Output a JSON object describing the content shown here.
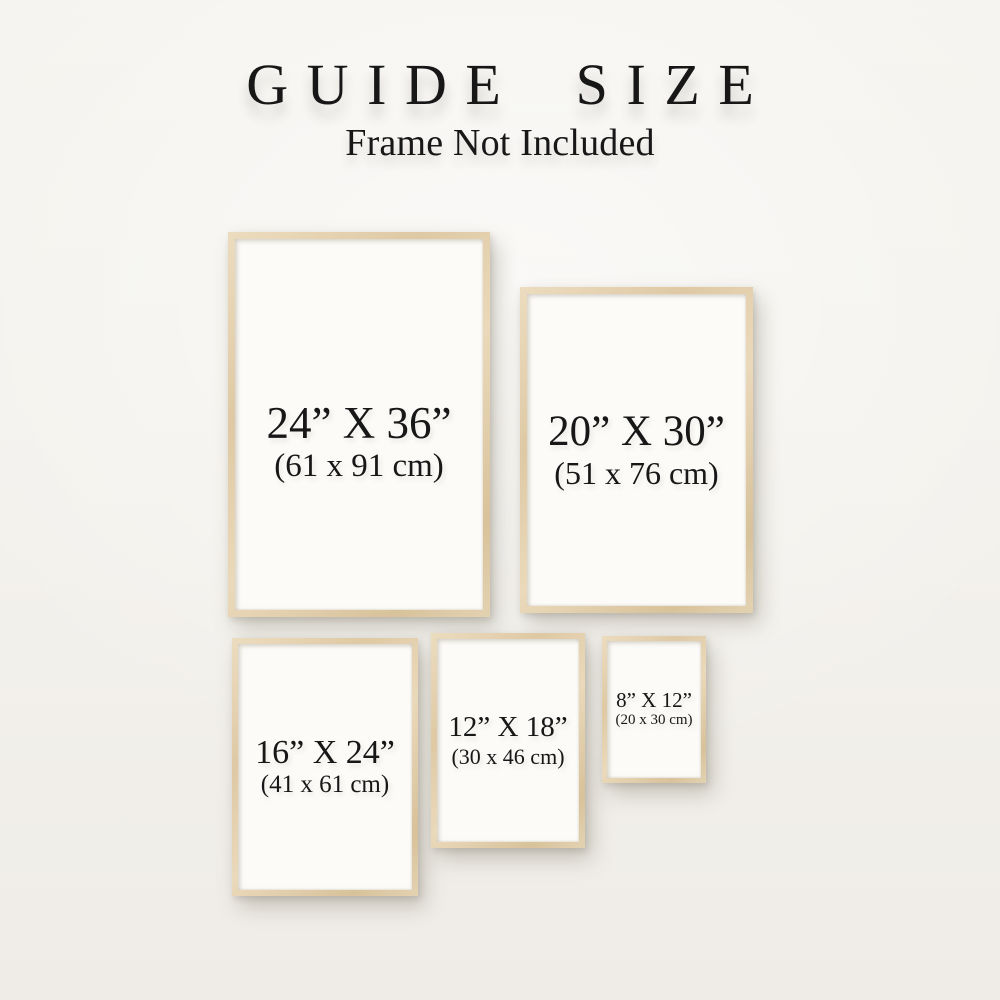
{
  "colors": {
    "background": "#f3f1ec",
    "frame_wood": "#dfc9a4",
    "paper": "#fcfbf8",
    "text": "#171717"
  },
  "header": {
    "title": "GUIDE SIZE",
    "subtitle": "Frame Not Included"
  },
  "frames": [
    {
      "name": "frame-24x36",
      "inches": "24” X 36”",
      "cm": "(61 x 91 cm)"
    },
    {
      "name": "frame-20x30",
      "inches": "20” X 30”",
      "cm": "(51 x 76 cm)"
    },
    {
      "name": "frame-16x24",
      "inches": "16” X 24”",
      "cm": "(41 x 61 cm)"
    },
    {
      "name": "frame-12x18",
      "inches": "12” X 18”",
      "cm": "(30 x 46 cm)"
    },
    {
      "name": "frame-8x12",
      "inches": "8” X 12”",
      "cm": "(20 x 30 cm)"
    }
  ]
}
